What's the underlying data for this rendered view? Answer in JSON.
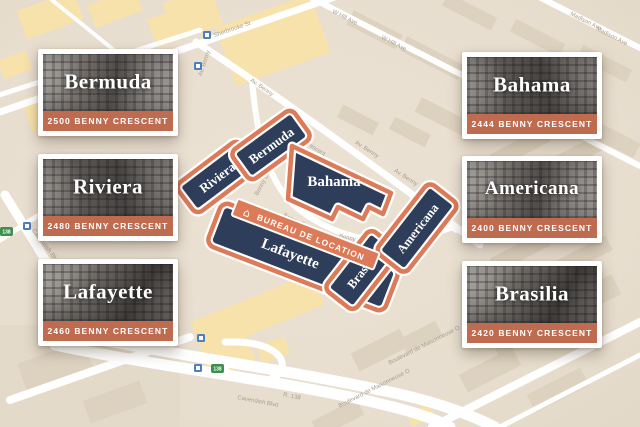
{
  "colors": {
    "map_background": "#e9dfd0",
    "building_fill": "#2e3e5a",
    "building_border": "#dd7a58",
    "card_address_bar": "#bf6b4f",
    "road": "#ffffff",
    "block_beige": "#ddd2bf",
    "block_yellow": "#f8e2ab"
  },
  "cards": [
    {
      "name": "Bermuda",
      "address": "2500 BENNY CRESCENT"
    },
    {
      "name": "Riviera",
      "address": "2480 BENNY CRESCENT"
    },
    {
      "name": "Lafayette",
      "address": "2460 BENNY CRESCENT"
    },
    {
      "name": "Bahama",
      "address": "2444 BENNY CRESCENT"
    },
    {
      "name": "Americana",
      "address": "2400 BENNY CRESCENT"
    },
    {
      "name": "Brasilia",
      "address": "2420 BENNY CRESCENT"
    }
  ],
  "map": {
    "buildings": [
      {
        "label": "Riviera"
      },
      {
        "label": "Bermuda"
      },
      {
        "label": "Bahama"
      },
      {
        "label": "Lafayette"
      },
      {
        "label": "Brasilia"
      },
      {
        "label": "Americana"
      }
    ],
    "ribbon": "BUREAU DE LOCATION",
    "streets": {
      "sherbrooke": "Sherbrooke St",
      "benny": "Av. Benny",
      "crescent": "Benny Crescent",
      "cavendish": "Cavendish Blvd",
      "maisonneuve": "Boulevard de Maisonneuve O",
      "madison": "Madison Ave",
      "whill": "W Hill Ave",
      "route": "R. 138"
    },
    "route_badge": "138"
  }
}
